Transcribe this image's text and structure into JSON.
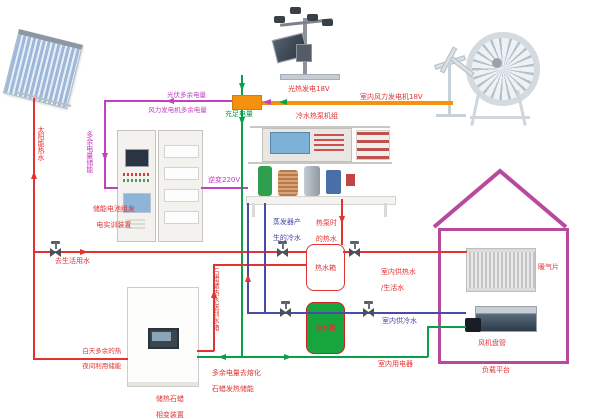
{
  "diagram": {
    "colors": {
      "hot_pipe": "#e23333",
      "excess_power": "#c040c0",
      "main_power": "#0aa04a",
      "wind_bus": "#f4920f",
      "cold_pipe": "#4a4aa8",
      "house_outline": "#b84a9e",
      "cold_tank_fill": "#17a53e"
    },
    "labels": {
      "excess_pv_line1": "光伏多余电量",
      "excess_pv_line2": "风力发电机多余电量",
      "sufficient_power": "充足电量",
      "pv_generation": "光热发电18V",
      "wind_generation": "室内风力发电机18V",
      "solar_hot_water": "太阳能热水",
      "excess_power_storage": "多余电量储能",
      "battery_device_line1": "储能电池组发",
      "battery_device_line2": "电实训装置",
      "inverter": "逆变220V",
      "heat_pump_unit": "冷水热泵机组",
      "evaporator_line1": "蒸发器产",
      "evaporator_line2": "生的冷水",
      "heatpump_hot_line1": "热泵时",
      "heatpump_hot_line2": "的热水",
      "hot_water_tank": "热水箱",
      "indoor_hot_line1": "室内供热水",
      "indoor_hot_line2": "/生活水",
      "radiator": "暖气片",
      "to_domestic_water": "去生活用水",
      "paraffin_to_tank": "石蜡储热水送到水箱",
      "day_excess_line1": "白天多余的热",
      "day_excess_line2": "夜间利用储能",
      "melt_line1": "多余电量去熔化",
      "melt_line2": "石蜡发热储能",
      "cold_water_tank": "冷水箱",
      "indoor_cold": "室内供冷水",
      "indoor_appliance": "室内用电器",
      "fan_coil": "风机盘管",
      "load_platform": "负载平台",
      "phase_device_line1": "储热石蜡",
      "phase_device_line2": "相变装置"
    }
  }
}
